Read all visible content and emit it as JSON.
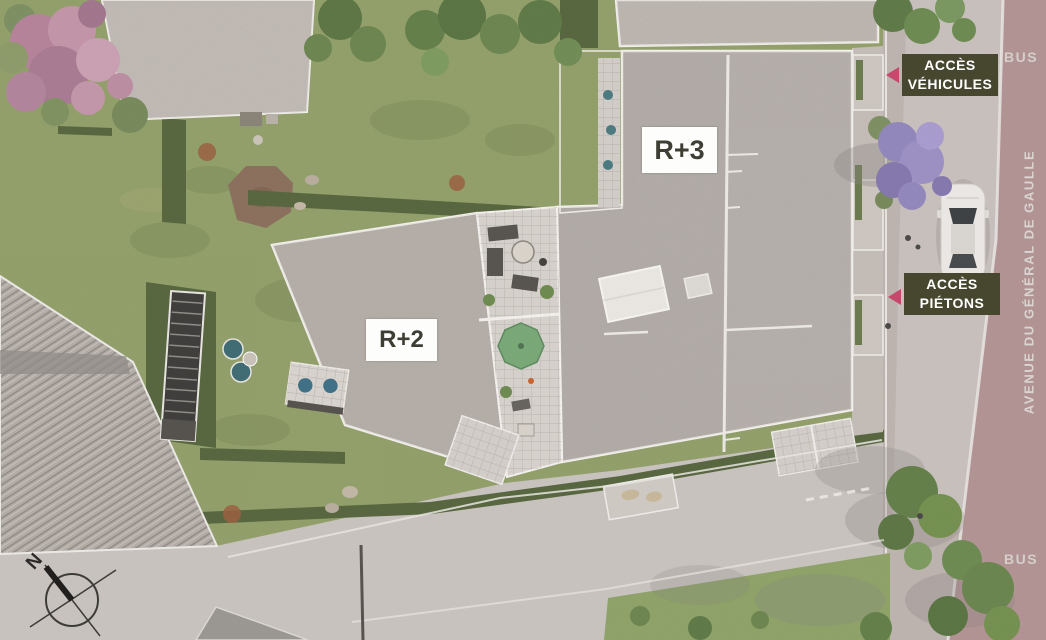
{
  "plan": {
    "buildings": [
      {
        "id": "r3",
        "label": "R+3"
      },
      {
        "id": "r2",
        "label": "R+2"
      }
    ],
    "access": [
      {
        "id": "vehicles",
        "line1": "ACCÈS",
        "line2": "VÉHICULES"
      },
      {
        "id": "pedestrians",
        "line1": "ACCÈS",
        "line2": "PIÉTONS"
      }
    ],
    "street": {
      "name": "AVENUE DU GÉNÉRAL DE GAULLE"
    },
    "bus_stops": {
      "top": "BUS",
      "bottom": "BUS"
    },
    "compass": {
      "north": "N"
    },
    "icons": {
      "access_arrow": "triangle-left",
      "compass": "compass-rose-north"
    },
    "colors": {
      "access_badge_bg": "#47462f",
      "access_badge_text": "#ffffff",
      "access_arrow": "#c6486c",
      "avenue_road": "#b29394",
      "road": "#c9c3c0",
      "grass": "#94a16c",
      "hedge": "#57663f",
      "roof_gravel": "#b7b0ab",
      "terrace_tile": "#d6d1cc",
      "label_box_bg": "#fdfdfc",
      "label_text": "#3e3e35",
      "car_body": "#ebe8e5"
    }
  }
}
